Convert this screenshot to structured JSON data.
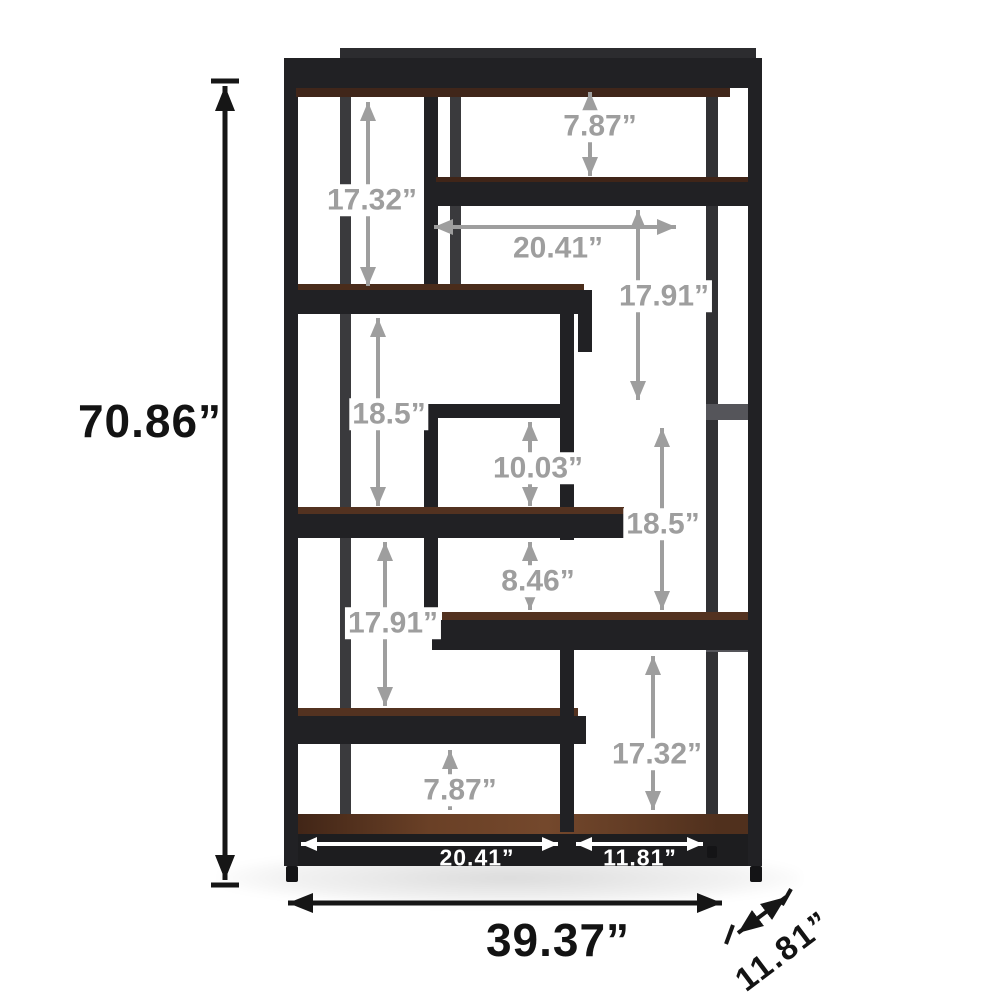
{
  "figure": {
    "type": "product-dimension-diagram",
    "subject": "staggered-8-tier-etagere-bookshelf",
    "background": "#ffffff"
  },
  "colors": {
    "frame_black": "#212124",
    "frame_rear_gray": "#3a3a3d",
    "wood_brown": "#6a4026",
    "dimension_gray": "#9e9e9e",
    "dimension_black": "#161616",
    "dimension_white": "#ffffff"
  },
  "dimensions": {
    "height_total": "70.86”",
    "width_total": "39.37”",
    "depth_total": "11.81”",
    "gap_top": "7.87”",
    "gap_upper_left": "17.32”",
    "width_upper_shelf": "20.41”",
    "gap_upper_right": "17.91”",
    "gap_mid_left": "18.5”",
    "gap_inner": "10.03”",
    "gap_mid_right": "18.5”",
    "gap_small": "8.46”",
    "gap_lower_left": "17.91”",
    "gap_lower_right": "17.32”",
    "gap_bottom": "7.87”",
    "width_bottom_left_shelf": "20.41”",
    "width_bottom_right_shelf": "11.81”"
  }
}
